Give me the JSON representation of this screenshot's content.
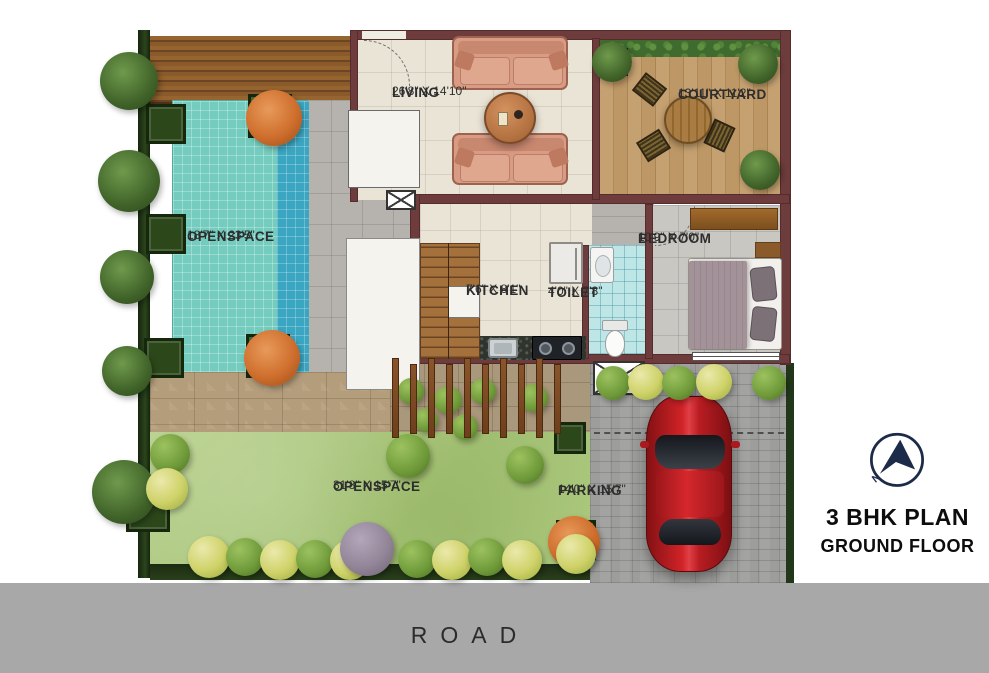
{
  "legend": {
    "title": "3 BHK PLAN",
    "subtitle": "GROUND FLOOR",
    "compass_letter": "N"
  },
  "road": {
    "label": "ROAD"
  },
  "rooms": {
    "living": {
      "name": "LIVING",
      "dims": "26'8\" X 14'10\""
    },
    "courtyard": {
      "name": "COURTYARD",
      "dims": "13'11\" X 11'2\""
    },
    "bedroom": {
      "name": "BEDROOM",
      "dims": "10'9\" X 7'0\""
    },
    "kitchen": {
      "name": "KITCHEN",
      "dims": "7'6\" X 8'1\""
    },
    "toilet": {
      "name": "TOILET",
      "dims": "4'0\" X 7'8\""
    },
    "openspace_pool": {
      "name": "OPENSPACE",
      "dims": "18'7\" X 23'5\""
    },
    "openspace_lawn": {
      "name": "OPENSPACE",
      "dims": "31'8\" X 15'7\""
    },
    "parking": {
      "name": "PARKING",
      "dims": "14'0\" X 15'7\""
    }
  },
  "colors": {
    "wall": "#6e3c3c",
    "pool": "#74ccbe",
    "lawn": "#aecb80",
    "road": "#a8a8a8",
    "car": "#c01e22",
    "compass_navy": "#1d2b4a"
  }
}
